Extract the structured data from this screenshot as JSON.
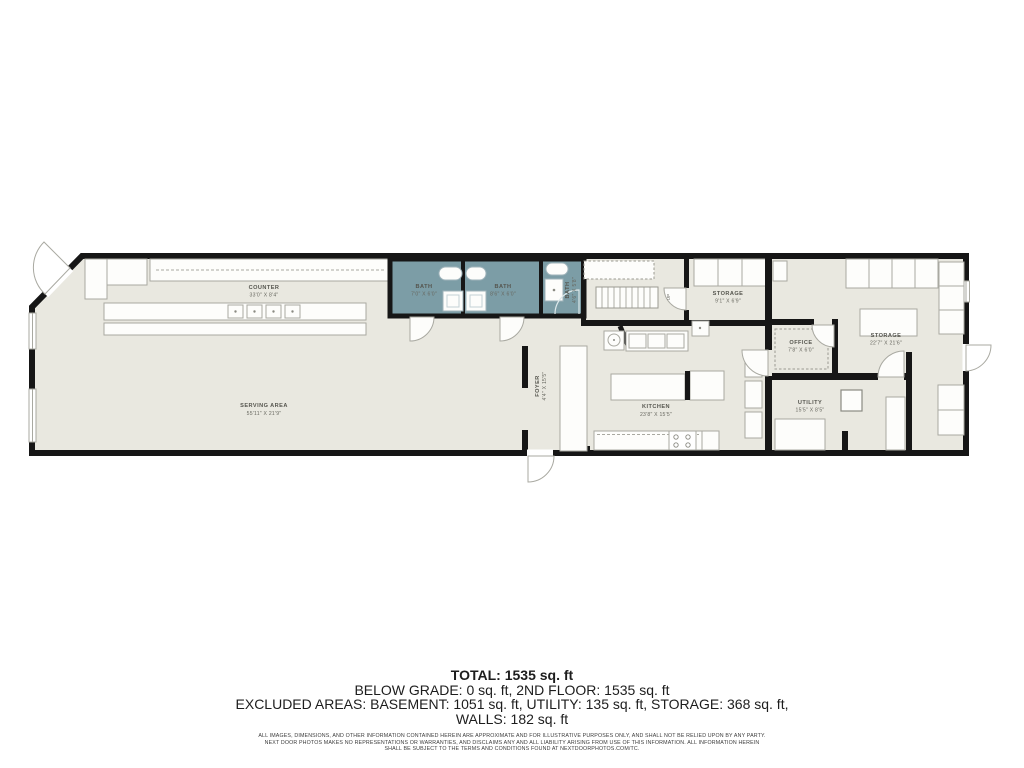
{
  "colors": {
    "floor": "#e9e8e0",
    "bath": "#7c9da6",
    "wall": "#161616"
  },
  "plan": {
    "rooms": {
      "counter": {
        "name": "COUNTER",
        "dims": "33'0\" X 8'4\""
      },
      "serving_area": {
        "name": "SERVING AREA",
        "dims": "55'11\" X 21'9\""
      },
      "bath_1": {
        "name": "BATH",
        "dims": "7'0\" X 6'0\""
      },
      "bath_2": {
        "name": "BATH",
        "dims": "8'6\" X 6'0\""
      },
      "bath_3": {
        "name": "BATH",
        "dims": "4'6\" X 5'8\""
      },
      "foyer": {
        "name": "FOYER",
        "dims": "4'4\" X 15'5\""
      },
      "kitchen": {
        "name": "KITCHEN",
        "dims": "23'8\" X 15'5\""
      },
      "storage_small": {
        "name": "STORAGE",
        "dims": "9'1\" X 6'9\""
      },
      "office": {
        "name": "OFFICE",
        "dims": "7'8\" X 6'0\""
      },
      "storage_large": {
        "name": "STORAGE",
        "dims": "22'7\" X 21'6\""
      },
      "utility": {
        "name": "UTILITY",
        "dims": "15'5\" X 8'5\""
      }
    },
    "stairs_label": "UP"
  },
  "summary": {
    "total": "TOTAL: 1535 sq. ft",
    "line_2": "BELOW GRADE: 0 sq. ft, 2ND FLOOR: 1535 sq. ft",
    "line_3": "EXCLUDED AREAS: BASEMENT: 1051 sq. ft, UTILITY: 135 sq. ft, STORAGE: 368 sq. ft,",
    "line_4": "WALLS: 182 sq. ft"
  },
  "disclaimer": {
    "line_1": "ALL IMAGES, DIMENSIONS, AND OTHER INFORMATION CONTAINED HEREIN ARE APPROXIMATE AND FOR ILLUSTRATIVE PURPOSES ONLY, AND SHALL NOT BE RELIED UPON BY ANY PARTY.",
    "line_2": "NEXT DOOR PHOTOS MAKES NO REPRESENTATIONS OR WARRANTIES, AND DISCLAIMS ANY AND ALL LIABILITY ARISING FROM USE OF THIS INFORMATION. ALL INFORMATION HEREIN",
    "line_3": "SHALL BE SUBJECT TO THE TERMS AND CONDITIONS FOUND AT NEXTDOORPHOTOS.COM/TC."
  }
}
